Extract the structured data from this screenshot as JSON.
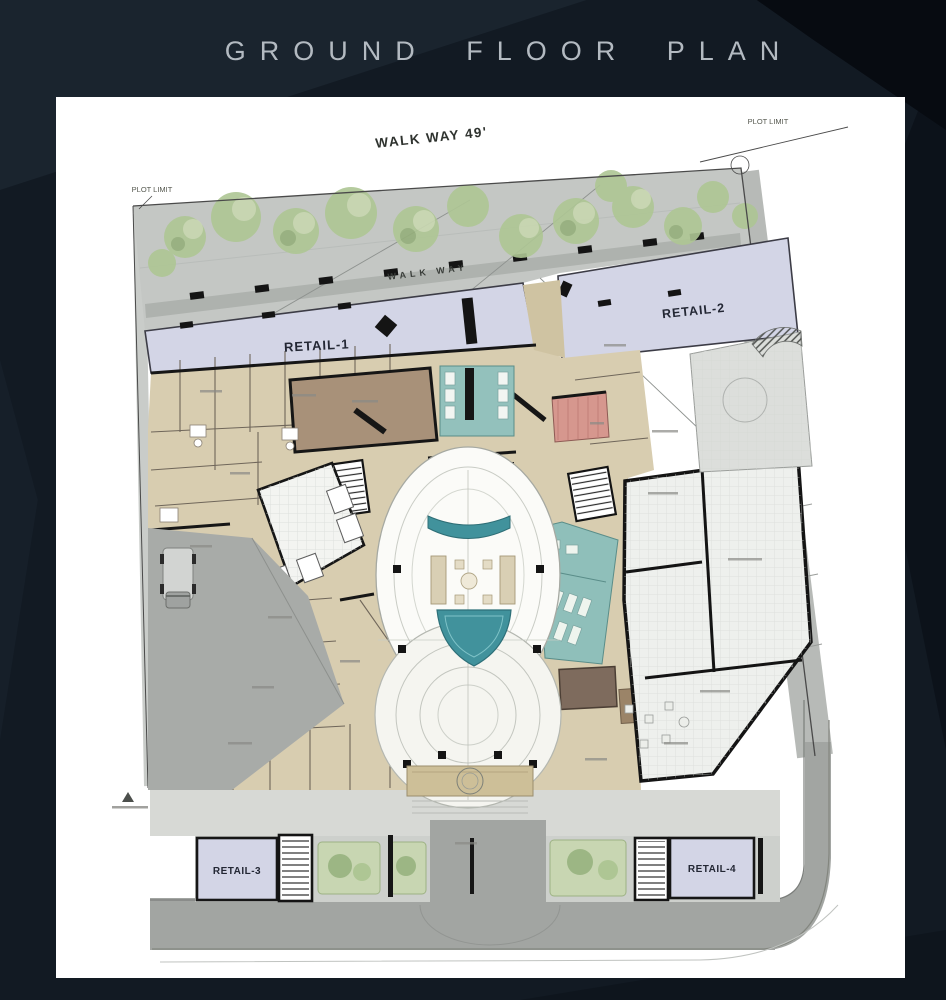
{
  "title": "GROUND FLOOR PLAN",
  "labels": {
    "walkway_top": "WALK WAY 49'",
    "plot_limit_left": "PLOT LIMIT",
    "plot_limit_right": "PLOT LIMIT",
    "walkway_inner": "WALK WAY",
    "retail_1": "RETAIL-1",
    "retail_2": "RETAIL-2",
    "retail_3": "RETAIL-3",
    "retail_4": "RETAIL-4"
  },
  "colors": {
    "background": "#121a23",
    "panel": "#ffffff",
    "title_text": "#b3bac1",
    "retail_fill": "#d3d5e6",
    "room_beige": "#d8cdb0",
    "water_teal": "#41929c",
    "washroom_teal": "#93c1bc",
    "walkway_gray": "#c4c7c4",
    "road_gray": "#a2a5a2",
    "tree_green": "#aec694",
    "wall_black": "#161616",
    "electrical_pink": "#d6978e"
  }
}
